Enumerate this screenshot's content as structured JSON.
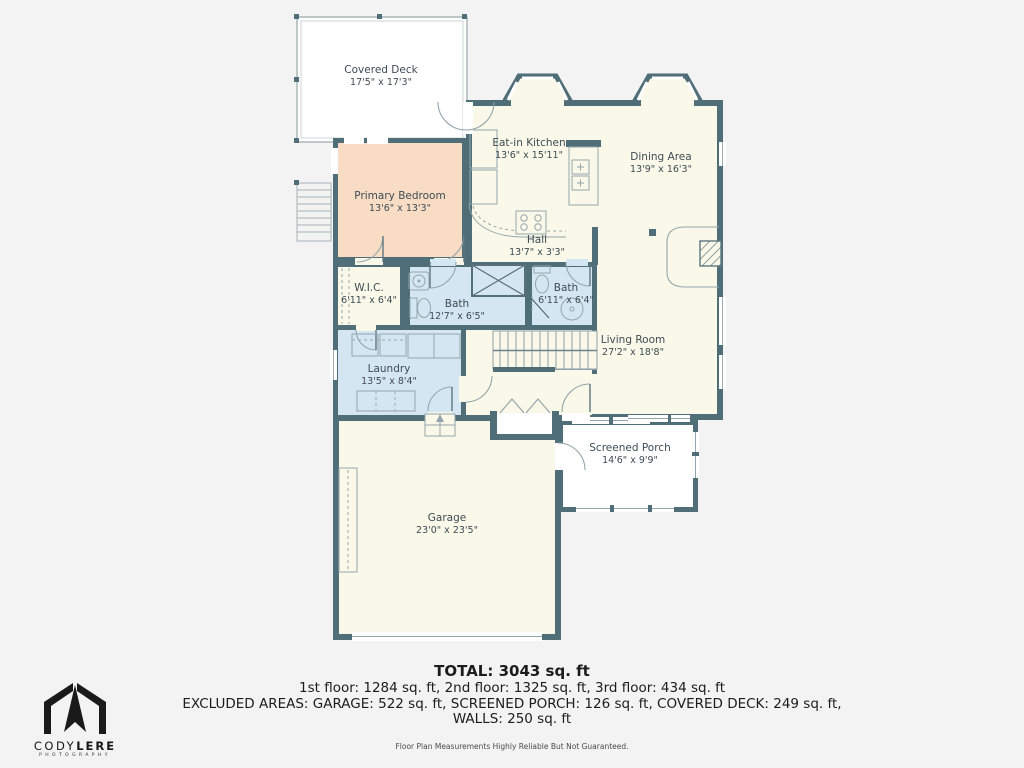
{
  "colors": {
    "wall": "#4f6e77",
    "cream": "#faf8e9",
    "peach": "#f8dcc4",
    "blue": "#d5e6f3",
    "background": "#f3f3f3"
  },
  "rooms": {
    "covered_deck": {
      "name": "Covered Deck",
      "dims": "17'5\" x 17'3\""
    },
    "eat_in_kitchen": {
      "name": "Eat-in Kitchen",
      "dims": "13'6\" x 15'11\""
    },
    "dining_area": {
      "name": "Dining Area",
      "dims": "13'9\" x 16'3\""
    },
    "primary_bedroom": {
      "name": "Primary Bedroom",
      "dims": "13'6\" x 13'3\""
    },
    "hall": {
      "name": "Hall",
      "dims": "13'7\" x 3'3\""
    },
    "wic": {
      "name": "W.I.C.",
      "dims": "6'11\" x 6'4\""
    },
    "bath_primary": {
      "name": "Bath",
      "dims": "12'7\" x 6'5\""
    },
    "bath_hall": {
      "name": "Bath",
      "dims": "6'11\" x 6'4\""
    },
    "living_room": {
      "name": "Living Room",
      "dims": "27'2\" x 18'8\""
    },
    "laundry": {
      "name": "Laundry",
      "dims": "13'5\" x 8'4\""
    },
    "garage": {
      "name": "Garage",
      "dims": "23'0\" x 23'5\""
    },
    "screened_porch": {
      "name": "Screened Porch",
      "dims": "14'6\" x 9'9\""
    }
  },
  "summary": {
    "total": "TOTAL: 3043 sq. ft",
    "floors": "1st floor: 1284 sq. ft, 2nd floor: 1325 sq. ft, 3rd floor: 434 sq. ft",
    "excluded": "EXCLUDED AREAS: GARAGE: 522 sq. ft, SCREENED PORCH: 126 sq. ft, COVERED DECK: 249 sq. ft,",
    "walls": "WALLS: 250 sq. ft",
    "disclaimer": "Floor Plan Measurements Highly Reliable But Not Guaranteed."
  },
  "logo": {
    "brand_primary": "CODY",
    "brand_secondary": "LERE",
    "subtitle": "PHOTOGRAPHY"
  }
}
